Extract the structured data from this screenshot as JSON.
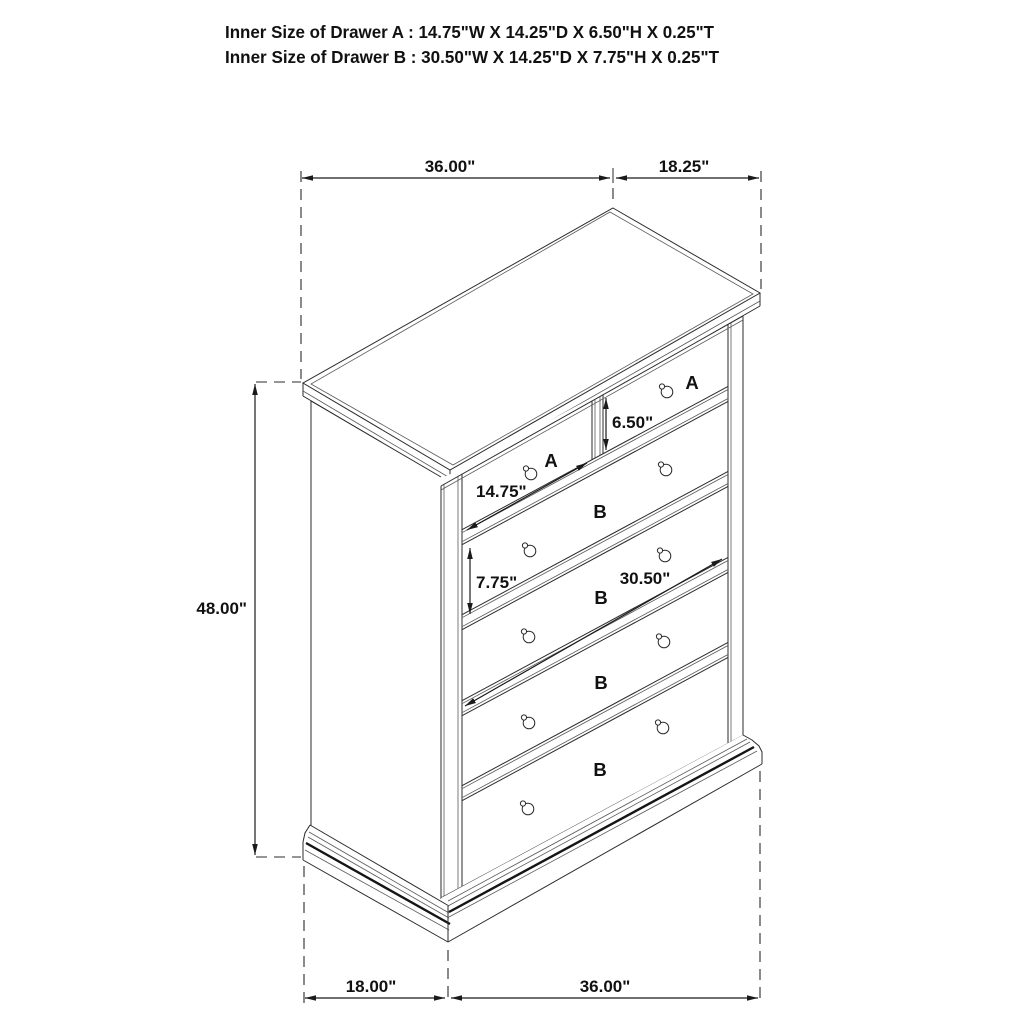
{
  "header": {
    "line1": "Inner Size of Drawer A : 14.75\"W X 14.25\"D X 6.50\"H X 0.25\"T",
    "line2": "Inner Size of Drawer B : 30.50\"W X 14.25\"D X 7.75\"H X 0.25\"T"
  },
  "dimensions": {
    "top_width": "36.00\"",
    "top_depth": "18.25\"",
    "height": "48.00\"",
    "bottom_depth": "18.00\"",
    "bottom_width": "36.00\"",
    "drawer_a_width": "14.75\"",
    "drawer_a_height": "6.50\"",
    "drawer_b_height": "7.75\"",
    "drawer_b_width": "30.50\""
  },
  "labels": {
    "drawer_a": "A",
    "drawer_b": "B"
  },
  "furniture": {
    "type": "chest-of-drawers",
    "drawer_count_a": 2,
    "drawer_count_b": 4
  },
  "colors": {
    "line": "#2b2b2b",
    "label_red": "#ed1111",
    "background": "#ffffff"
  }
}
